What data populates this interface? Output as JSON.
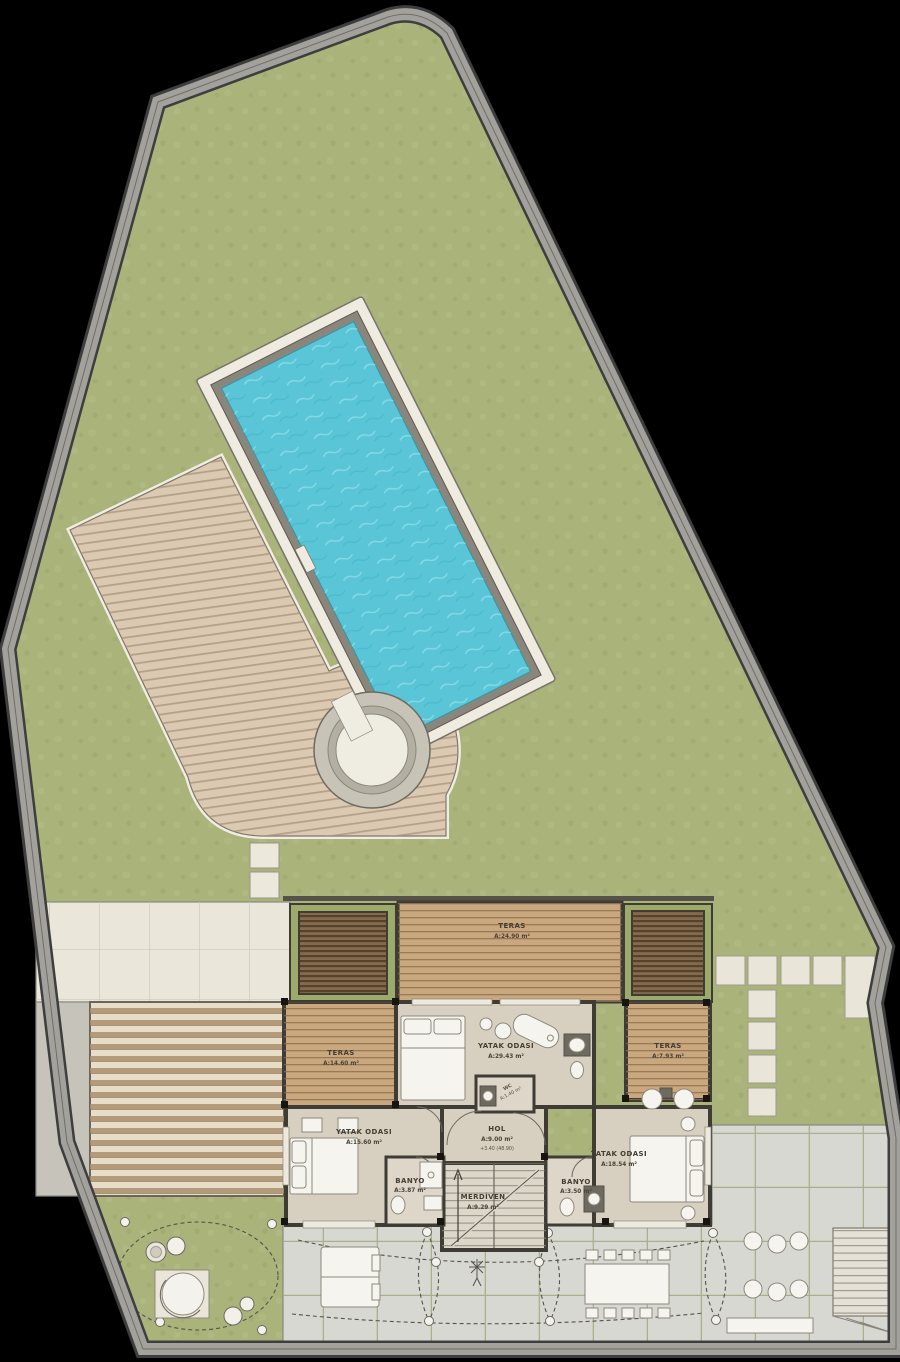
{
  "rooms": {
    "teras_top": {
      "label": "TERAS",
      "area": "A:24.90 m²"
    },
    "teras_left": {
      "label": "TERAS",
      "area": "A:14.60 m²"
    },
    "teras_right": {
      "label": "TERAS",
      "area": "A:7.93 m²"
    },
    "yatak_center": {
      "label": "YATAK ODASI",
      "area": "A:29.43 m²"
    },
    "yatak_left": {
      "label": "YATAK ODASI",
      "area": "A:15.60 m²"
    },
    "yatak_right": {
      "label": "YATAK ODASI",
      "area": "A:18.54 m²"
    },
    "hol": {
      "label": "HOL",
      "area": "A:9.00 m²",
      "elevation": "+3.40 (48.90)"
    },
    "banyo_left": {
      "label": "BANYO",
      "area": "A:3.87 m²"
    },
    "banyo_right": {
      "label": "BANYO",
      "area": "A:3.50 m²"
    },
    "merdiven": {
      "label": "MERDİVEN",
      "area": "A:9.29 m²"
    },
    "wc": {
      "label": "WC",
      "area": "A:1.40 m²"
    }
  },
  "colors": {
    "background": "#000000",
    "lawn": "#a9b37a",
    "boundary_wall": "#a2a19c",
    "pool_water": "#59c5d6",
    "pool_coping": "#8a867c",
    "pool_frame": "#f0ebe0",
    "deck": "#dbc9b2",
    "terrace_wood": "#c9a77f",
    "pergola_louver": "#856b4d",
    "pergola_slat_area": "#e7ddc9",
    "hedge": "#9cab6c",
    "interior_floor": "#d7d0c1",
    "bath_floor": "#ddd6c9",
    "tile_patio": "#ebe6da",
    "paver_patio": "#d8d8d2",
    "stair_tread": "#ddd7c9",
    "stone": "#e9e5d9",
    "dark_wall": "#3f3c36"
  }
}
